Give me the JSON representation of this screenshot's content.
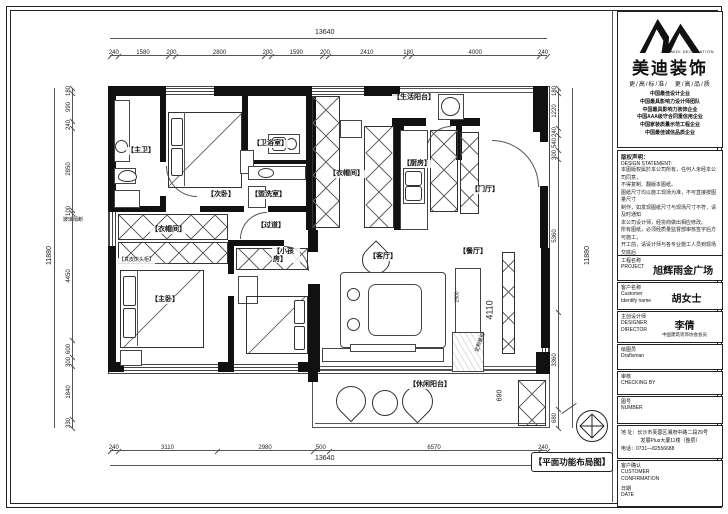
{
  "page": {
    "plan_title": "【平面功能布局图】"
  },
  "logo": {
    "company": "美迪装饰",
    "company_en": "MIDI DECORATION",
    "slogan": "更/高/标/准/　更/高/品/质",
    "honors": [
      "中国最佳设计企业",
      "中国最具影响力设计师团队",
      "中国最具影响力装饰企业",
      "中国AAA级守合同重信用企业",
      "中国家装质量示范工程企业",
      "中国最佳诚信品质企业"
    ]
  },
  "statement": {
    "title": "版权声明：",
    "title_en": "DESIGN STATEMENT:",
    "lines": [
      "本图版权属於本公司所有，任何人未经本公司同意，",
      "不得复制、翻版本图纸。",
      "图纸尺寸均以施工现场为准，不可直接按图量尺寸",
      "制作，如发现图纸尺寸与现场尺寸不符，请及时通知",
      "本公司设计师，经协商做出相应修改。",
      "所有图纸，必须经质量监督部审核签字后方可施工，",
      "开工前，请设计师与各专业施工人员到现场交底后",
      "方可施工。",
      "施工中如发现与图纸不符之处，须及时与设计师联",
      "系解决。",
      "未经审核的图纸不得施工（含预算与图纸），否则后",
      "果一切责任与本公司无关。"
    ]
  },
  "fields": {
    "project": {
      "label": "工程名称",
      "label_en": "PROJECT",
      "value": "旭辉雨金广场"
    },
    "customer": {
      "label": "客户名称",
      "label_en": "Customer",
      "label_en2": "Identify name",
      "value": "胡女士"
    },
    "designer": {
      "label": "主创设计师",
      "label_en": "DESIGNER",
      "label_en2": "DIRECTOR",
      "value": "李倩",
      "value_sub": "中国建筑装饰协会会员"
    },
    "draftsman": {
      "label": "绘图员",
      "label_en": "Draftsman",
      "value": ""
    },
    "checker": {
      "label": "审核",
      "label_en": "CHECKING BY",
      "value": ""
    },
    "number": {
      "label": "图号",
      "label_en": "NUMBER",
      "value": ""
    },
    "address": {
      "line1": "地 址：长沙市芙蓉区湘府中路二段29号",
      "line2": "发展Plus大厦11楼（整层）",
      "line3": "电话：0731—82556688"
    },
    "confirm": {
      "label": "客户确认",
      "label_en": "CUSTOMER",
      "label_en2": "CONFIRMATION",
      "date_label": "日期",
      "date_label_en": "DATE"
    }
  },
  "plan": {
    "rooms": {
      "master_bath": "【主卫】",
      "second_bedroom": "【次卧】",
      "bathroom": "【卫浴室】",
      "washroom": "【盥洗室】",
      "closet_center": "【衣帽间】",
      "closet_master": "【衣帽间】",
      "corridor": "【过道】",
      "kids_room": "【小孩房】",
      "master_bedroom": "【主卧】",
      "living_room": "【客厅】",
      "dining_room": "【餐厅】",
      "entry": "【门厅】",
      "kitchen": "【厨房】",
      "utility_balcony": "【生活阳台】",
      "leisure_balcony": "【休闲阳台】"
    },
    "annotations": {
      "headboard": "【真皮床头柜】",
      "glass_partition": "玻璃隔断",
      "dining_cabinet": "定制餐柜"
    },
    "dims": {
      "top": {
        "total": "13640",
        "values": [
          "240",
          "1580",
          "200",
          "2800",
          "200",
          "1590",
          "200",
          "2410",
          "180",
          "4000",
          "240"
        ]
      },
      "bottom": {
        "total": "13640",
        "values": [
          "240",
          "3110",
          "2980",
          "500",
          "6570",
          "240"
        ]
      },
      "left": {
        "total": "11880",
        "values": [
          "180",
          "990",
          "240",
          "2850",
          "100",
          "4450",
          "600",
          "300",
          "1840",
          "330"
        ]
      },
      "right": {
        "total": "11880",
        "values": [
          "180",
          "1220",
          "240",
          "540",
          "300",
          "5360",
          "3360",
          "680"
        ]
      },
      "interior": {
        "living": "4110",
        "balcony_cabinet": "690",
        "tall_cabinet": "1500"
      }
    }
  }
}
